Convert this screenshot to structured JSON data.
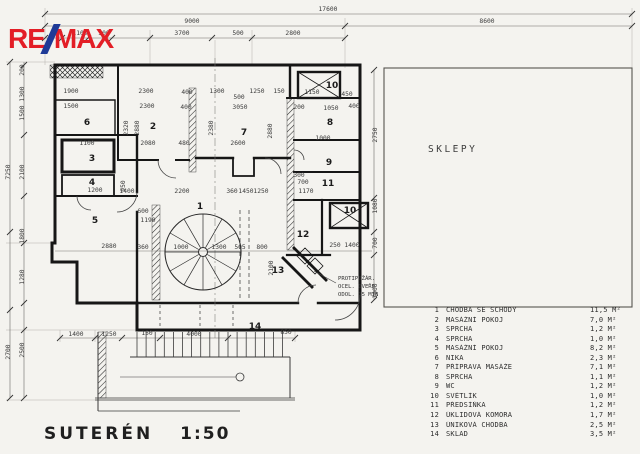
{
  "logo": {
    "prefix": "RE",
    "suffix": "MAX",
    "red": "#e31e26",
    "blue": "#1e3a97"
  },
  "title": {
    "label": "SUTERÉN",
    "scale": "1:50"
  },
  "right_area_label": "SKLEPY",
  "note": {
    "lines": [
      "PROTIPOŽÁR.",
      "OCEL. DVEŘE",
      "ODOL. 15 MIN"
    ]
  },
  "legend": {
    "rows": [
      {
        "num": "1",
        "name": "CHODBA SE SCHODY",
        "area": "11,5 M²"
      },
      {
        "num": "2",
        "name": "MASÁŽNÍ POKOJ",
        "area": "7,0 M²"
      },
      {
        "num": "3",
        "name": "SPRCHA",
        "area": "1,2 M²"
      },
      {
        "num": "4",
        "name": "SPRCHA",
        "area": "1,0 M²"
      },
      {
        "num": "5",
        "name": "MASÁŽNÍ POKOJ",
        "area": "8,2 M²"
      },
      {
        "num": "6",
        "name": "NIKA",
        "area": "2,3 M²"
      },
      {
        "num": "7",
        "name": "PŘÍPRAVA MASÁŽE",
        "area": "7,1 M²"
      },
      {
        "num": "8",
        "name": "SPRCHA",
        "area": "1,1 M²"
      },
      {
        "num": "9",
        "name": "WC",
        "area": "1,2 M²"
      },
      {
        "num": "10",
        "name": "SVĚTLÍK",
        "area": "1,0 M²"
      },
      {
        "num": "11",
        "name": "PŘEDSÍŇKA",
        "area": "1,2 M²"
      },
      {
        "num": "12",
        "name": "ÚKLIDOVÁ KOMORA",
        "area": "1,7 M²"
      },
      {
        "num": "13",
        "name": "ÚNIKOVÁ CHODBA",
        "area": "2,5 M²"
      },
      {
        "num": "14",
        "name": "SKLAD",
        "area": "3,5 M²"
      }
    ]
  },
  "plan": {
    "rooms": [
      {
        "n": "1",
        "x": 200,
        "y": 209
      },
      {
        "n": "2",
        "x": 153,
        "y": 129
      },
      {
        "n": "3",
        "x": 92,
        "y": 161
      },
      {
        "n": "4",
        "x": 92,
        "y": 185
      },
      {
        "n": "5",
        "x": 95,
        "y": 223
      },
      {
        "n": "6",
        "x": 87,
        "y": 125
      },
      {
        "n": "7",
        "x": 244,
        "y": 135
      },
      {
        "n": "8",
        "x": 330,
        "y": 125
      },
      {
        "n": "9",
        "x": 329,
        "y": 165
      },
      {
        "n": "10",
        "x": 332,
        "y": 88
      },
      {
        "n": "10",
        "x": 350,
        "y": 213
      },
      {
        "n": "11",
        "x": 328,
        "y": 186
      },
      {
        "n": "12",
        "x": 303,
        "y": 237
      },
      {
        "n": "13",
        "x": 278,
        "y": 273
      },
      {
        "n": "14",
        "x": 255,
        "y": 329
      }
    ],
    "dims": [
      {
        "t": "17600",
        "x": 328,
        "y": 11
      },
      {
        "t": "9000",
        "x": 192,
        "y": 23
      },
      {
        "t": "8600",
        "x": 487,
        "y": 23
      },
      {
        "t": "300",
        "x": 57,
        "y": 35
      },
      {
        "t": "1100",
        "x": 80,
        "y": 35
      },
      {
        "t": "500",
        "x": 104,
        "y": 35
      },
      {
        "t": "3700",
        "x": 182,
        "y": 35
      },
      {
        "t": "500",
        "x": 238,
        "y": 35
      },
      {
        "t": "2800",
        "x": 293,
        "y": 35
      },
      {
        "t": "7250",
        "x": 10,
        "y": 172,
        "r": -90
      },
      {
        "t": "2700",
        "x": 10,
        "y": 352,
        "r": -90
      },
      {
        "t": "200",
        "x": 24,
        "y": 70,
        "r": -90
      },
      {
        "t": "1300",
        "x": 24,
        "y": 94,
        "r": -90
      },
      {
        "t": "1500",
        "x": 24,
        "y": 113,
        "r": -90
      },
      {
        "t": "2100",
        "x": 24,
        "y": 172,
        "r": -90
      },
      {
        "t": "1800",
        "x": 24,
        "y": 236,
        "r": -90
      },
      {
        "t": "1280",
        "x": 24,
        "y": 277,
        "r": -90
      },
      {
        "t": "2500",
        "x": 24,
        "y": 350,
        "r": -90
      },
      {
        "t": "2750",
        "x": 377,
        "y": 135,
        "r": -90
      },
      {
        "t": "1080",
        "x": 377,
        "y": 206,
        "r": -90
      },
      {
        "t": "700",
        "x": 377,
        "y": 243,
        "r": -90
      },
      {
        "t": "1000",
        "x": 377,
        "y": 291,
        "r": -90
      },
      {
        "t": "1400",
        "x": 76,
        "y": 336
      },
      {
        "t": "1250",
        "x": 109,
        "y": 336
      },
      {
        "t": "150",
        "x": 147,
        "y": 335
      },
      {
        "t": "4000",
        "x": 194,
        "y": 336
      },
      {
        "t": "850",
        "x": 286,
        "y": 334
      },
      {
        "t": "1900",
        "x": 71,
        "y": 93
      },
      {
        "t": "1500",
        "x": 71,
        "y": 108
      },
      {
        "t": "2300",
        "x": 146,
        "y": 93
      },
      {
        "t": "2300",
        "x": 147,
        "y": 108
      },
      {
        "t": "400",
        "x": 187,
        "y": 94
      },
      {
        "t": "400",
        "x": 186,
        "y": 109
      },
      {
        "t": "1300",
        "x": 217,
        "y": 93
      },
      {
        "t": "500",
        "x": 239,
        "y": 99
      },
      {
        "t": "3050",
        "x": 240,
        "y": 109
      },
      {
        "t": "1250",
        "x": 257,
        "y": 93
      },
      {
        "t": "150",
        "x": 279,
        "y": 93
      },
      {
        "t": "1150",
        "x": 312,
        "y": 94
      },
      {
        "t": "450",
        "x": 347,
        "y": 96
      },
      {
        "t": "400",
        "x": 354,
        "y": 108
      },
      {
        "t": "200",
        "x": 299,
        "y": 109
      },
      {
        "t": "1050",
        "x": 331,
        "y": 110
      },
      {
        "t": "2320",
        "x": 128,
        "y": 128,
        "r": -90
      },
      {
        "t": "2880",
        "x": 139,
        "y": 128,
        "r": -90
      },
      {
        "t": "2380",
        "x": 213,
        "y": 128,
        "r": -90
      },
      {
        "t": "2880",
        "x": 272,
        "y": 131,
        "r": -90
      },
      {
        "t": "1100",
        "x": 87,
        "y": 145
      },
      {
        "t": "2080",
        "x": 148,
        "y": 145
      },
      {
        "t": "480",
        "x": 184,
        "y": 145
      },
      {
        "t": "2600",
        "x": 238,
        "y": 145
      },
      {
        "t": "1000",
        "x": 323,
        "y": 140
      },
      {
        "t": "1200",
        "x": 95,
        "y": 192
      },
      {
        "t": "1400",
        "x": 127,
        "y": 193
      },
      {
        "t": "2200",
        "x": 182,
        "y": 193
      },
      {
        "t": "360",
        "x": 232,
        "y": 193
      },
      {
        "t": "1450",
        "x": 246,
        "y": 193
      },
      {
        "t": "1250",
        "x": 261,
        "y": 193
      },
      {
        "t": "950",
        "x": 125,
        "y": 186,
        "r": -90
      },
      {
        "t": "600",
        "x": 143,
        "y": 213
      },
      {
        "t": "1190",
        "x": 148,
        "y": 222
      },
      {
        "t": "2880",
        "x": 109,
        "y": 248
      },
      {
        "t": "360",
        "x": 143,
        "y": 249
      },
      {
        "t": "1000",
        "x": 181,
        "y": 249
      },
      {
        "t": "1300",
        "x": 219,
        "y": 249
      },
      {
        "t": "505",
        "x": 240,
        "y": 249
      },
      {
        "t": "800",
        "x": 262,
        "y": 249
      },
      {
        "t": "2100",
        "x": 273,
        "y": 268,
        "r": -90
      },
      {
        "t": "700",
        "x": 303,
        "y": 184
      },
      {
        "t": "1170",
        "x": 306,
        "y": 193
      },
      {
        "t": "300",
        "x": 299,
        "y": 177
      },
      {
        "t": "250",
        "x": 335,
        "y": 247
      },
      {
        "t": "1400",
        "x": 352,
        "y": 247
      }
    ]
  }
}
